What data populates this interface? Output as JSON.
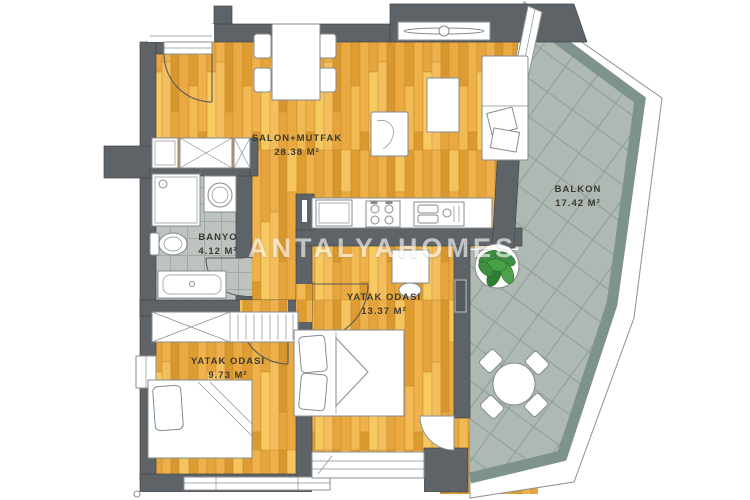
{
  "plan": {
    "watermark": "ANTALYAHOMES",
    "rooms": [
      {
        "id": "salon-mutfak",
        "name": "SALON+MUTFAK",
        "area": "28.38 M²"
      },
      {
        "id": "balkon",
        "name": "BALKON",
        "area": "17.42 M²"
      },
      {
        "id": "banyo",
        "name": "BANYO",
        "area": "4.12 M²"
      },
      {
        "id": "yatak-odasi-1",
        "name": "YATAK ODASI",
        "area": "13.37 M²"
      },
      {
        "id": "yatak-odasi-2",
        "name": "YATAK ODASI",
        "area": "9.73 M²"
      }
    ],
    "colors": {
      "wood": "#E2A035",
      "wall": "#5E6367",
      "balcony_tile": "#AEB9B3",
      "balcony_band": "#7E938E",
      "bath_tile": "#BDC4C0",
      "plant_green": "#3E8E41",
      "label_text": "#3C3A30",
      "watermark": "#FFFFFF"
    }
  }
}
